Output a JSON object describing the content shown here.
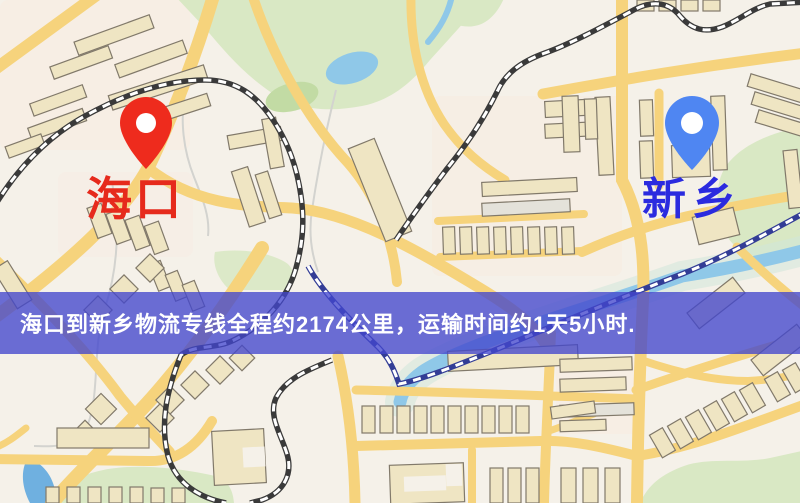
{
  "banner": {
    "text": "海口到新乡物流专线全程约2174公里，运输时间约1天5小时.",
    "bg_color": "#4246cd",
    "text_color": "#ffffff"
  },
  "route": {
    "from": "海口",
    "to": "新乡",
    "distance": "约2174公里",
    "duration": "约1天5小时"
  },
  "markers": {
    "origin": {
      "label": "海口",
      "pin_color": "#ee2b1d",
      "label_color": "#e62a1c",
      "icon": "map-pin-icon"
    },
    "destination": {
      "label": "新乡",
      "pin_color": "#4f86f2",
      "label_color": "#2b2bdf",
      "icon": "map-pin-icon"
    }
  },
  "map_palette": {
    "background": "#f5f1e9",
    "road": "#f6d37c",
    "building": "#efe5c3",
    "park": "#d9e8c4",
    "water": "#8fc8e8",
    "railway_dark": "#3a3a3a",
    "railway_navy": "#333d96"
  }
}
